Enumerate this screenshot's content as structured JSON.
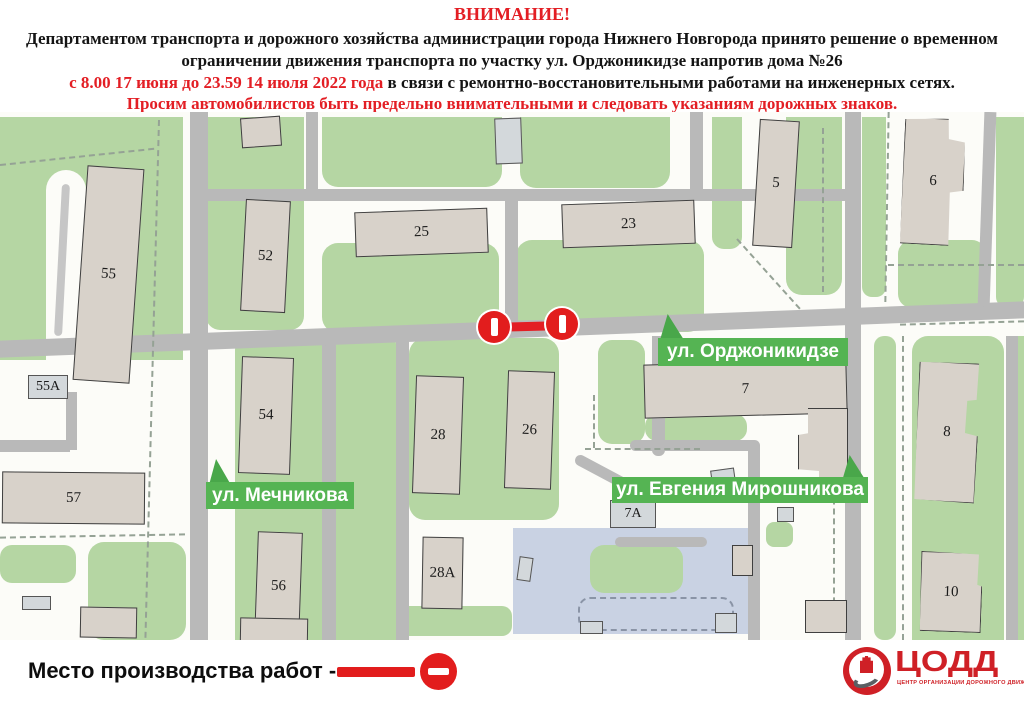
{
  "header": {
    "title": "ВНИМАНИЕ!",
    "paragraph1": "Департаментом транспорта и дорожного хозяйства администрации города Нижнего Новгорода принято решение о временном ограничении движения транспорта по участку ул. Орджоникидзе напротив дома №26",
    "period_red": "с 8.00 17 июня до 23.59 14 июля 2022 года",
    "reason_black": " в связи с ремонтно-восстановительными работами на инженерных сетях.",
    "appeal_red": "Просим автомобилистов быть предельно внимательными и следовать указаниям дорожных знаков."
  },
  "map": {
    "street_labels": {
      "ordzhonikidze": "ул. Орджоникидзе",
      "mechnikova": "ул. Мечникова",
      "miroshnikova": "ул. Евгения Мирошникова"
    },
    "buildings": {
      "b55": "55",
      "b55a": "55А",
      "b57": "57",
      "b52": "52",
      "b54": "54",
      "b56": "56",
      "b25": "25",
      "b23": "23",
      "b28": "28",
      "b26": "26",
      "b28a": "28А",
      "b5": "5",
      "b6": "6",
      "b7": "7",
      "b7a": "7А",
      "b8": "8",
      "b10": "10"
    },
    "colors": {
      "park_green": "#b5d6a3",
      "street_label_green": "#55b453",
      "road_gray": "#b9b9b9",
      "building_fill": "#d8d2ca",
      "school_area_blue": "#c9d2e3",
      "closure_red": "#e21d1d",
      "header_accent_red": "#e31e24"
    }
  },
  "legend": {
    "work_site_label": "Место производства работ -"
  },
  "logo": {
    "acronym": "ЦОДД",
    "subtitle": "ЦЕНТР ОРГАНИЗАЦИИ ДОРОЖНОГО ДВИЖЕНИЯ"
  }
}
